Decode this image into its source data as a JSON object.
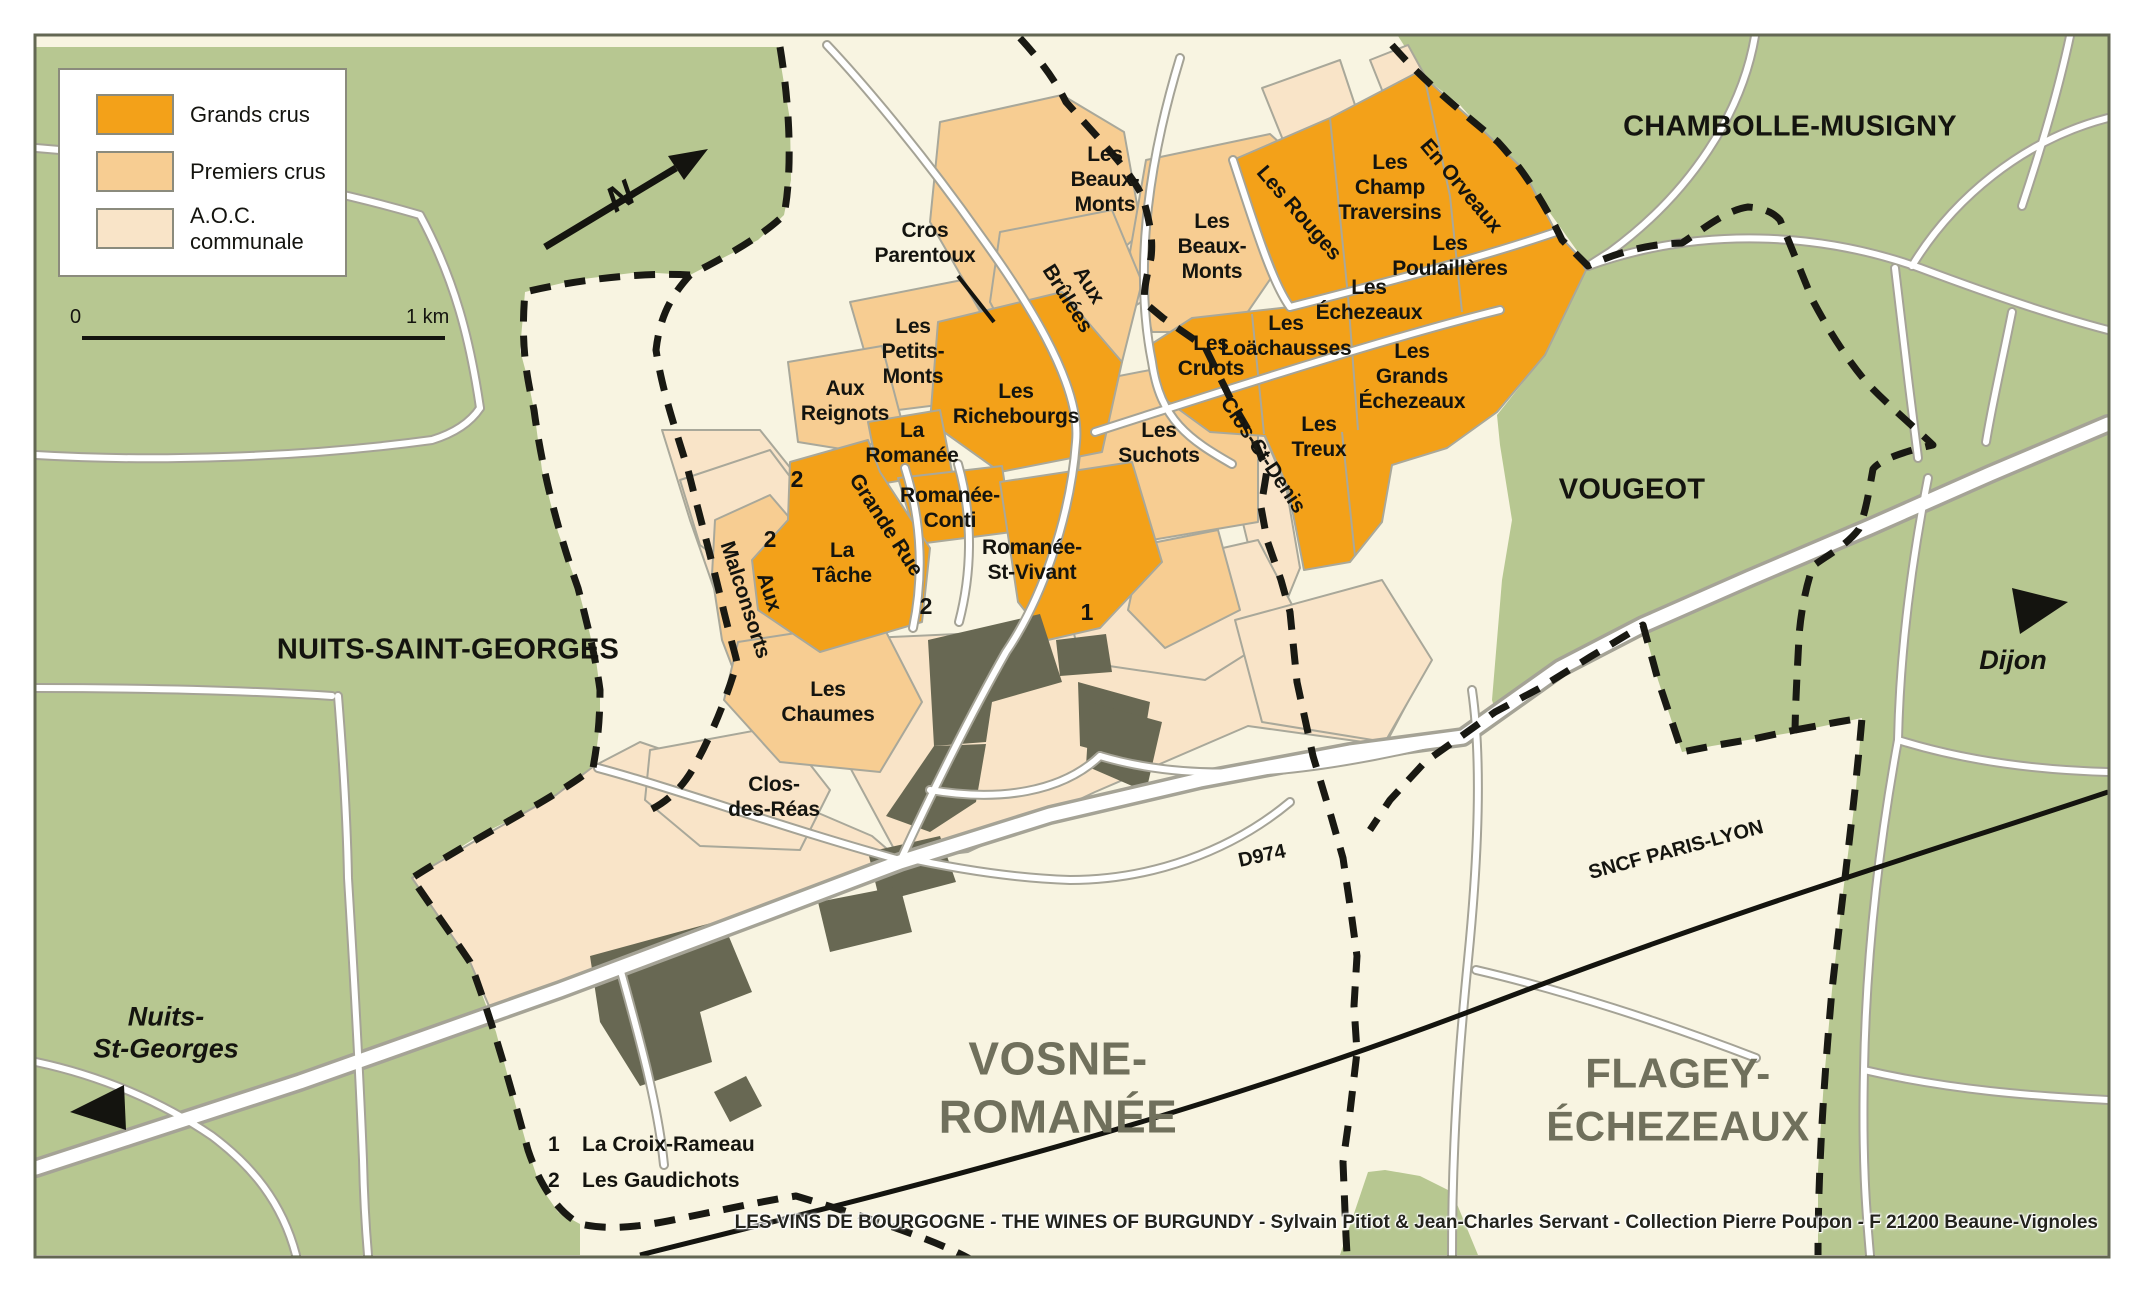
{
  "legend": {
    "items": [
      {
        "name": "grands-crus",
        "label": "Grands crus",
        "color": "#f3a119"
      },
      {
        "name": "premiers-crus",
        "label": "Premiers crus",
        "color": "#f7cd92"
      },
      {
        "name": "aoc-communale",
        "label": "A.O.C. communale",
        "color": "#f9e4c8"
      }
    ]
  },
  "scale_bar": {
    "start": "0",
    "end": "1 km"
  },
  "compass": {
    "label": "N"
  },
  "footnotes": [
    {
      "num": "1",
      "label": "La Croix-Rameau"
    },
    {
      "num": "2",
      "label": "Les Gaudichots"
    }
  ],
  "attribution": "LES VINS DE BOURGOGNE - THE WINES OF BURGUNDY - Sylvain Pitiot & Jean-Charles Servant - Collection Pierre Poupon - F 21200 Beaune-Vignoles",
  "colors": {
    "background_green": "#b7c791",
    "communal_cream": "#f8f4e1",
    "aoc_peach": "#f9e4c8",
    "premiers": "#f7cd92",
    "grands": "#f3a119",
    "village": "#686853",
    "boundary_dash": "#191913",
    "railway": "#14140f",
    "commune_big_text": "#70705c"
  },
  "labels": [
    {
      "name": "label-chambolle-musigny",
      "text": "CHAMBOLLE-MUSIGNY",
      "x": 1790,
      "y": 127,
      "rot": 0,
      "cls": "commune"
    },
    {
      "name": "label-vougeot",
      "text": "VOUGEOT",
      "x": 1632,
      "y": 490,
      "rot": 0,
      "cls": "commune"
    },
    {
      "name": "label-nuits-saint-georges",
      "text": "NUITS-SAINT-GEORGES",
      "x": 448,
      "y": 650,
      "rot": 0,
      "cls": "commune"
    },
    {
      "name": "label-vosne-romanee",
      "text": "VOSNE-\nROMANÉE",
      "x": 1058,
      "y": 1088,
      "rot": 0,
      "cls": "commune-big"
    },
    {
      "name": "label-flagey-echezeaux",
      "text": "FLAGEY-\nÉCHEZEAUX",
      "x": 1678,
      "y": 1100,
      "rot": 0,
      "cls": "commune-big flagey"
    },
    {
      "name": "label-dijon-direction",
      "text": "Dijon",
      "x": 2013,
      "y": 660,
      "rot": 0,
      "cls": "city"
    },
    {
      "name": "label-nuits-st-georges-direction",
      "text": "Nuits-\nSt-Georges",
      "x": 166,
      "y": 1033,
      "rot": 0,
      "cls": "city"
    },
    {
      "name": "label-d974",
      "text": "D974",
      "x": 1262,
      "y": 856,
      "rot": -12,
      "cls": "road-label"
    },
    {
      "name": "label-sncf-paris-lyon",
      "text": "SNCF PARIS-LYON",
      "x": 1676,
      "y": 850,
      "rot": -15,
      "cls": "road-label"
    },
    {
      "name": "label-les-beaux-monts-west",
      "text": "Les\nBeaux-\nMonts",
      "x": 1105,
      "y": 180,
      "rot": 0,
      "cls": "vy"
    },
    {
      "name": "label-les-beaux-monts-east",
      "text": "Les\nBeaux-\nMonts",
      "x": 1212,
      "y": 247,
      "rot": 0,
      "cls": "vy"
    },
    {
      "name": "label-cros-parentoux",
      "text": "Cros\nParentoux",
      "x": 925,
      "y": 243,
      "rot": 0,
      "cls": "vy"
    },
    {
      "name": "label-aux-brulees",
      "text": "Aux\nBrûlées",
      "x": 1078,
      "y": 292,
      "rot": 58,
      "cls": "vy"
    },
    {
      "name": "label-les-petits-monts",
      "text": "Les\nPetits-\nMonts",
      "x": 913,
      "y": 352,
      "rot": 0,
      "cls": "vy"
    },
    {
      "name": "label-aux-reignots",
      "text": "Aux\nReignots",
      "x": 845,
      "y": 401,
      "rot": 0,
      "cls": "vy"
    },
    {
      "name": "label-les-richebourgs",
      "text": "Les\nRichebourgs",
      "x": 1016,
      "y": 404,
      "rot": 0,
      "cls": "vy"
    },
    {
      "name": "label-la-romanee",
      "text": "La\nRomanée",
      "x": 912,
      "y": 443,
      "rot": 0,
      "cls": "vy"
    },
    {
      "name": "label-romanee-conti",
      "text": "Romanée-\nConti",
      "x": 950,
      "y": 508,
      "rot": 0,
      "cls": "vy"
    },
    {
      "name": "label-romanee-st-vivant",
      "text": "Romanée-\nSt-Vivant",
      "x": 1032,
      "y": 560,
      "rot": 0,
      "cls": "vy"
    },
    {
      "name": "label-la-tache",
      "text": "La\nTâche",
      "x": 842,
      "y": 563,
      "rot": 0,
      "cls": "vy"
    },
    {
      "name": "label-grande-rue",
      "text": "Grande Rue",
      "x": 886,
      "y": 525,
      "rot": 57,
      "cls": "vy"
    },
    {
      "name": "label-aux-malconsorts",
      "text": "Aux\nMalconsorts",
      "x": 757,
      "y": 596,
      "rot": 72,
      "cls": "vy"
    },
    {
      "name": "label-les-suchots",
      "text": "Les\nSuchots",
      "x": 1159,
      "y": 443,
      "rot": 0,
      "cls": "vy"
    },
    {
      "name": "label-les-rouges",
      "text": "Les Rouges",
      "x": 1299,
      "y": 213,
      "rot": 49,
      "cls": "vy"
    },
    {
      "name": "label-les-champ-traversins",
      "text": "Les\nChamp\nTraversins",
      "x": 1390,
      "y": 188,
      "rot": 0,
      "cls": "vy"
    },
    {
      "name": "label-en-orveaux",
      "text": "En Orveaux",
      "x": 1461,
      "y": 186,
      "rot": 50,
      "cls": "vy"
    },
    {
      "name": "label-les-poulailleres",
      "text": "Les\nPoulaillères",
      "x": 1450,
      "y": 256,
      "rot": 0,
      "cls": "vy"
    },
    {
      "name": "label-les-echezeaux",
      "text": "Les\nÉchezeaux",
      "x": 1369,
      "y": 300,
      "rot": 0,
      "cls": "vy"
    },
    {
      "name": "label-les-loachausses",
      "text": "Les\nLoächausses",
      "x": 1286,
      "y": 336,
      "rot": 0,
      "cls": "vy"
    },
    {
      "name": "label-les-cruots",
      "text": "Les\nCruots",
      "x": 1211,
      "y": 356,
      "rot": 0,
      "cls": "vy"
    },
    {
      "name": "label-clos-st-denis",
      "text": "Clos-St-Denis",
      "x": 1263,
      "y": 455,
      "rot": 56,
      "cls": "vy"
    },
    {
      "name": "label-les-treux",
      "text": "Les\nTreux",
      "x": 1319,
      "y": 437,
      "rot": 0,
      "cls": "vy"
    },
    {
      "name": "label-les-grands-echezeaux",
      "text": "Les\nGrands\nÉchezeaux",
      "x": 1412,
      "y": 377,
      "rot": 0,
      "cls": "vy"
    },
    {
      "name": "label-les-chaumes",
      "text": "Les\nChaumes",
      "x": 828,
      "y": 702,
      "rot": 0,
      "cls": "vy"
    },
    {
      "name": "label-clos-des-reas",
      "text": "Clos-\ndes-Réas",
      "x": 774,
      "y": 797,
      "rot": 0,
      "cls": "vy"
    },
    {
      "name": "marker-2-les-gaudichots-north",
      "text": "2",
      "x": 797,
      "y": 480,
      "rot": 0,
      "cls": "num"
    },
    {
      "name": "marker-2-west",
      "text": "2",
      "x": 770,
      "y": 540,
      "rot": 0,
      "cls": "num"
    },
    {
      "name": "marker-2-south",
      "text": "2",
      "x": 926,
      "y": 607,
      "rot": 0,
      "cls": "num"
    },
    {
      "name": "marker-1-la-croix-rameau",
      "text": "1",
      "x": 1087,
      "y": 613,
      "rot": 0,
      "cls": "num"
    },
    {
      "name": "compass-n-letter",
      "text": "N",
      "x": 620,
      "y": 196,
      "rot": -30,
      "cls": "north"
    }
  ]
}
